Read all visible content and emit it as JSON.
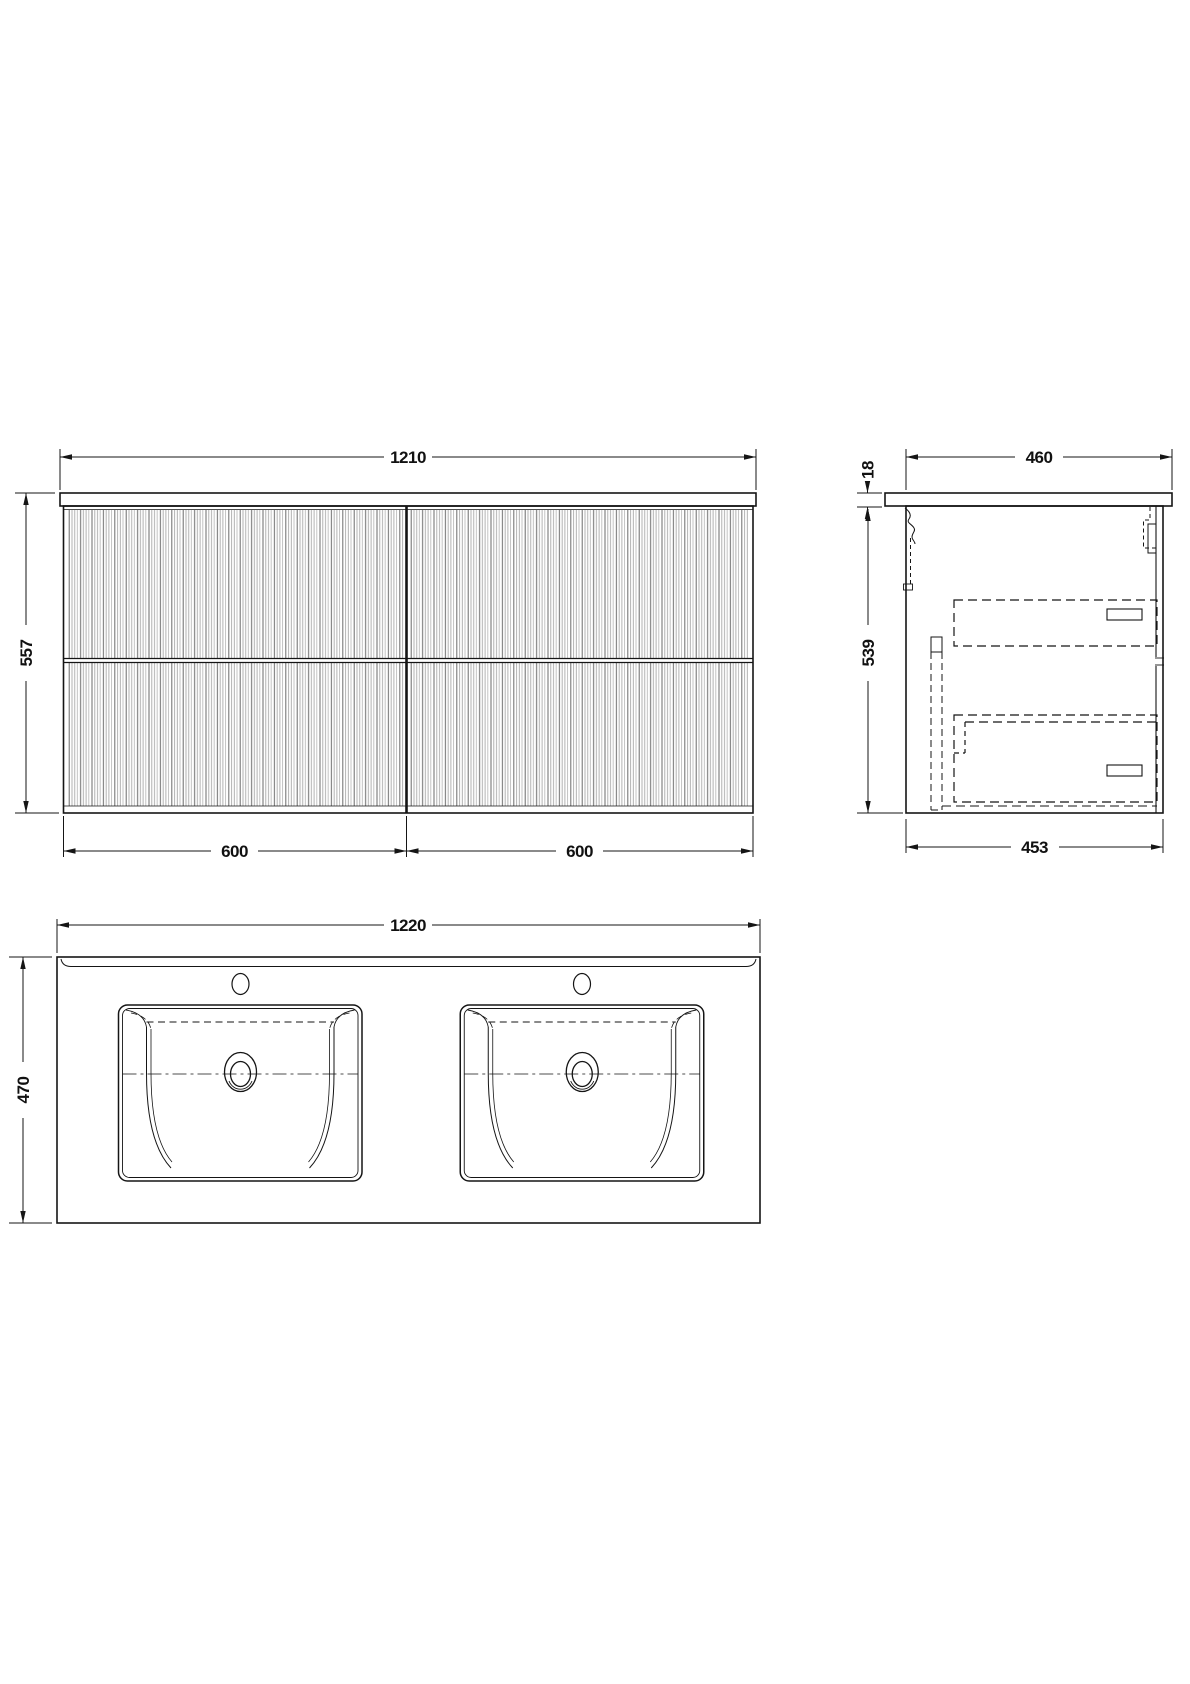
{
  "drawing": {
    "type": "vanity-unit-technical-drawing",
    "views": {
      "front": {
        "name": "front-elevation",
        "dims": {
          "overall_width": "1210",
          "overall_height": "557",
          "left_section_width": "600",
          "right_section_width": "600"
        }
      },
      "side": {
        "name": "side-section",
        "dims": {
          "top_depth": "460",
          "top_thickness": "18",
          "cabinet_height": "539",
          "cabinet_depth": "453"
        }
      },
      "plan": {
        "name": "basin-top-plan",
        "dims": {
          "top_width": "1220",
          "top_depth": "470"
        }
      }
    },
    "colors": {
      "line": "#151515",
      "flute_dark": "#6a6a6a",
      "flute_light": "#a9a9a9",
      "background": "#ffffff"
    }
  }
}
